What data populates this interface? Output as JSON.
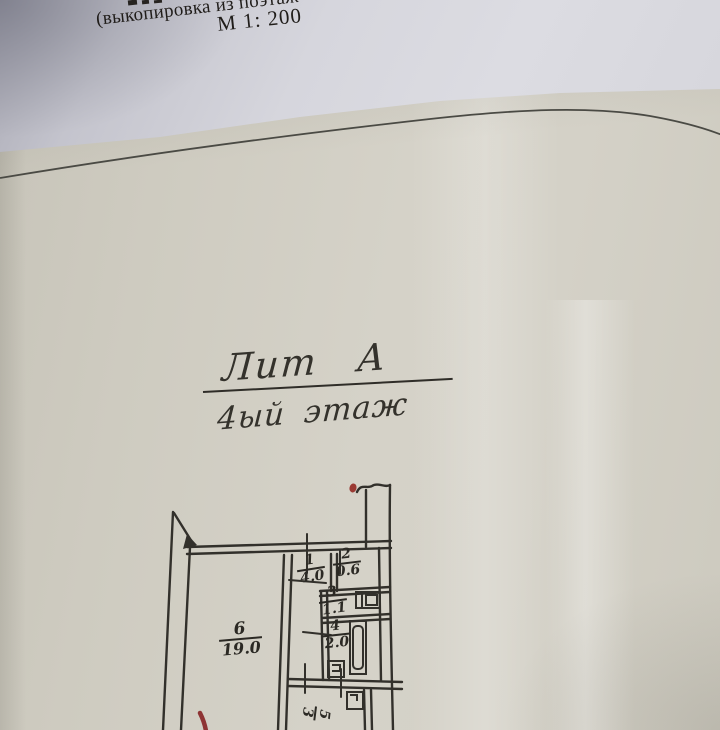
{
  "printed": {
    "subtitle": "(выкопировка из поэтаж",
    "scale": "М 1: 200"
  },
  "handwritten": {
    "liter": "Лит А",
    "floor": "4ый этаж"
  },
  "plan": {
    "rooms": [
      {
        "number": "1",
        "area": "4.0"
      },
      {
        "number": "2",
        "area": "0.6"
      },
      {
        "number": "3",
        "area": "1.1"
      },
      {
        "number": "4",
        "area": "2.0"
      },
      {
        "number": "5",
        "area": "3"
      },
      {
        "number": "6",
        "area": "19.0"
      }
    ],
    "fixture_icons": [
      "sink-icon",
      "bathtub-icon",
      "toilet-icon",
      "stove-icon"
    ]
  },
  "colors": {
    "ink": "#32302b",
    "printed_text": "#201d1a",
    "red_mark": "#993a35",
    "paper_beige": "#d0cdc3",
    "paper_white": "#d8d8de"
  }
}
